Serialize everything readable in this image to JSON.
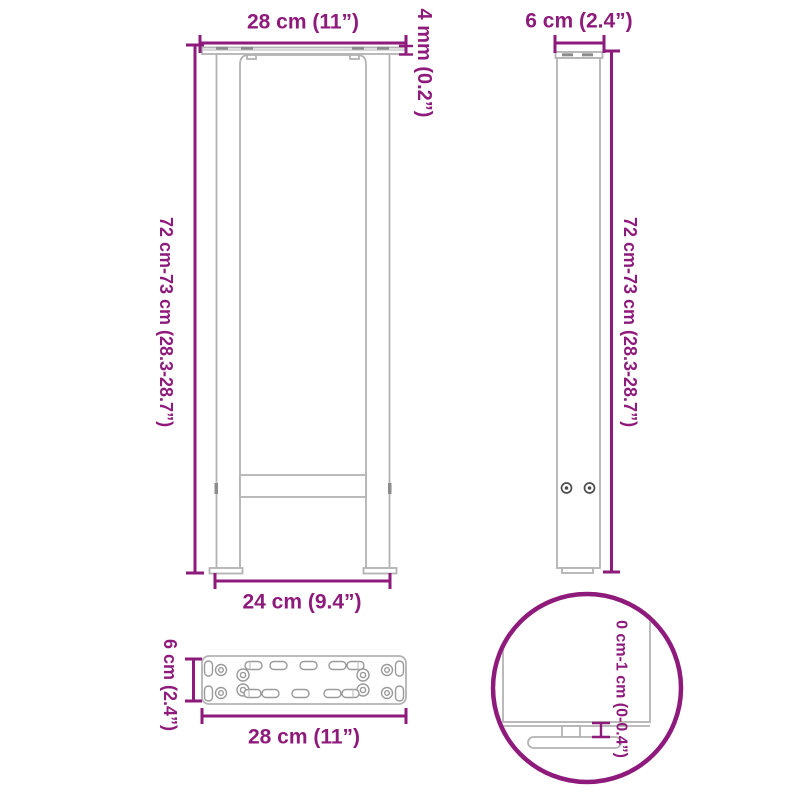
{
  "diagram": {
    "accent_color": "#8E1A7B",
    "outline_color": "#B3B3B3",
    "front_view": {
      "top_width": "28 cm (11”)",
      "plate_thickness": "4 mm (0.2”)",
      "height_range": "72 cm-73 cm (28.3-28.7”)",
      "base_width": "24 cm (9.4”)"
    },
    "side_view": {
      "depth": "6 cm (2.4”)",
      "height_range": "72 cm-73 cm (28.3-28.7”)"
    },
    "plate_view": {
      "depth": "6 cm (2.4”)",
      "width": "28 cm (11”)"
    },
    "foot_detail": {
      "adjustable_range": "0 cm-1 cm (0-0.4”)"
    }
  }
}
